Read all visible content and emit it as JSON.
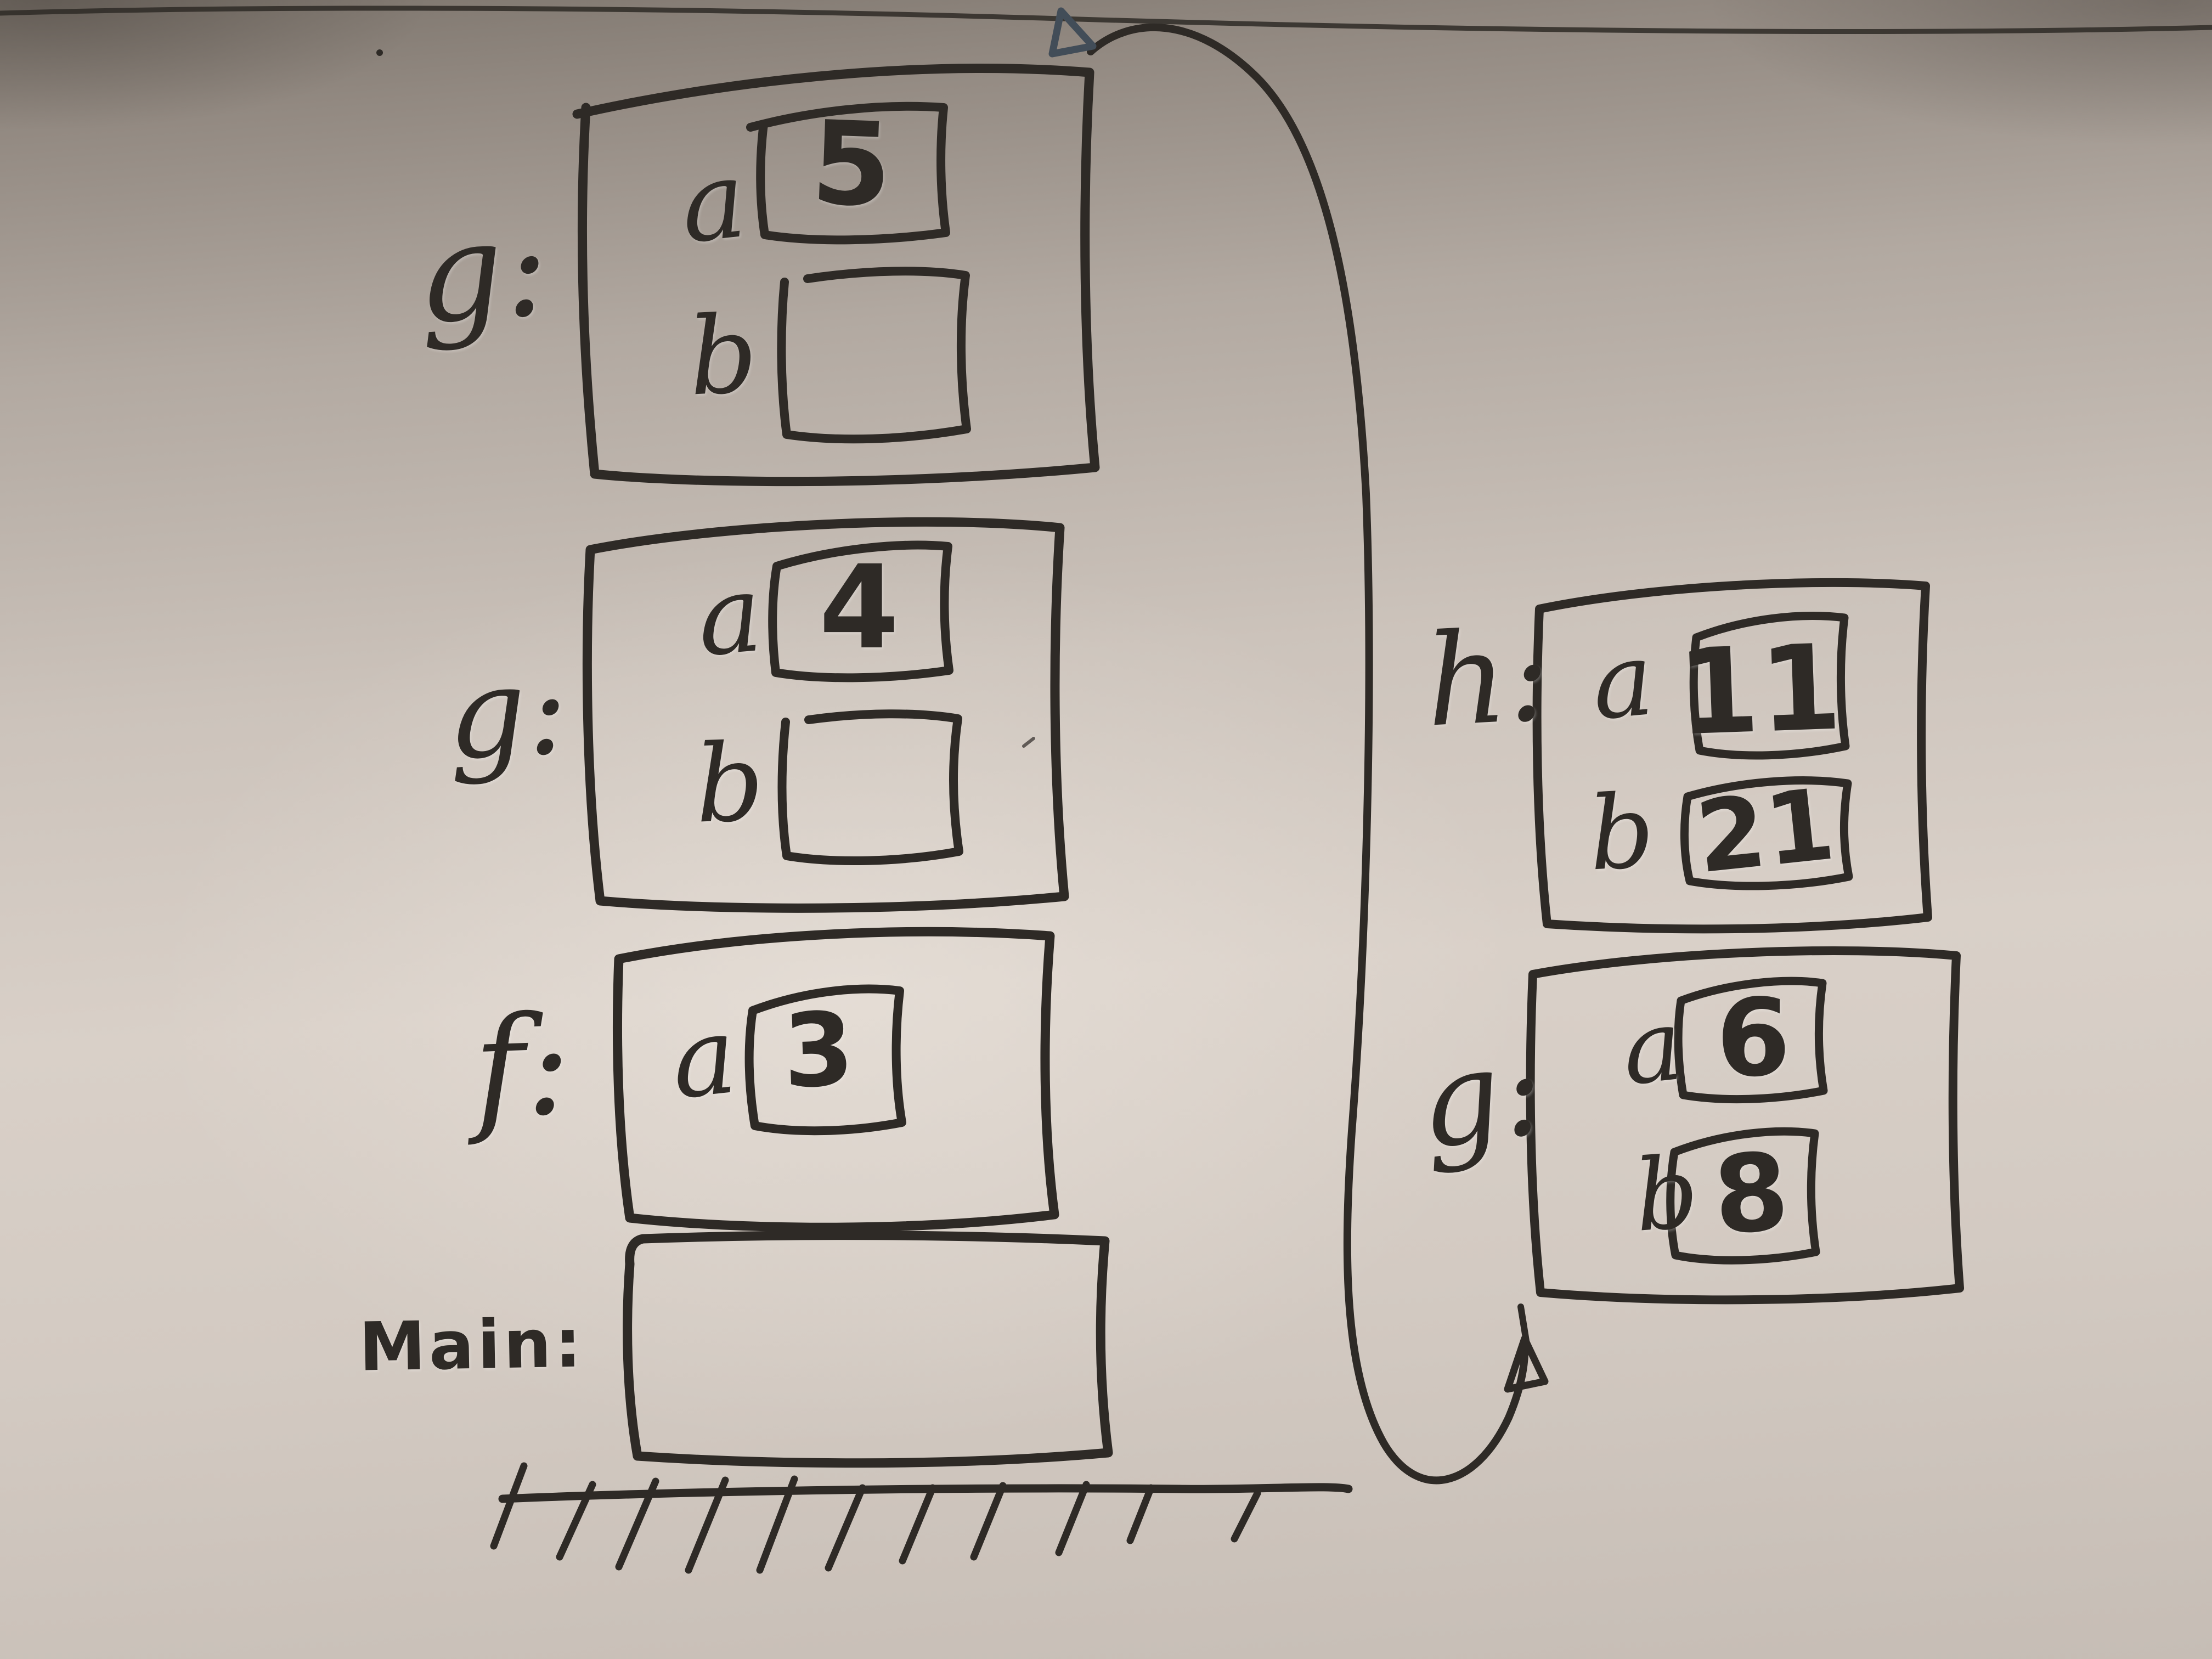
{
  "stack_frames": [
    {
      "label": "g:",
      "variables": [
        {
          "name": "a",
          "value": "5"
        },
        {
          "name": "b",
          "value": ""
        }
      ]
    },
    {
      "label": "g:",
      "variables": [
        {
          "name": "a",
          "value": "4"
        },
        {
          "name": "b",
          "value": ""
        }
      ]
    },
    {
      "label": "f:",
      "variables": [
        {
          "name": "a",
          "value": "3"
        }
      ]
    },
    {
      "label": "Main:",
      "variables": []
    }
  ],
  "side_frames": [
    {
      "label": "h:",
      "variables": [
        {
          "name": "a",
          "value": "11"
        },
        {
          "name": "b",
          "value": "21"
        }
      ]
    },
    {
      "label": "g:",
      "variables": [
        {
          "name": "a",
          "value": "6"
        },
        {
          "name": "b",
          "value": "8"
        }
      ]
    }
  ],
  "colors": {
    "ink": "#2e2a26",
    "arrowhead_blue": "#424d58",
    "board_light": "#d5ccc4",
    "board_dark": "#7e766e"
  }
}
